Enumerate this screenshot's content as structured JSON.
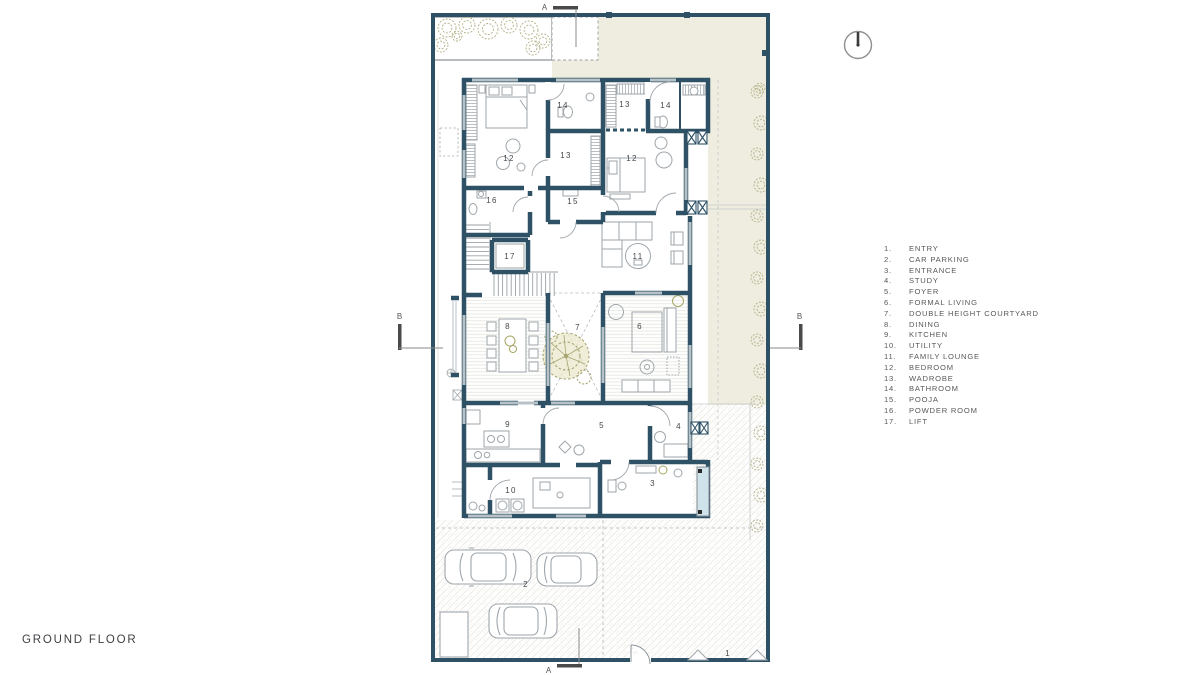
{
  "page": {
    "floor_label": "GROUND FLOOR"
  },
  "compass": {
    "icon": "north-indicator"
  },
  "colors": {
    "wall": "#2e5166",
    "beige": "#eeede0",
    "plant": "#b3b086",
    "glass": "#cfe3ea"
  },
  "section_markers": [
    {
      "label": "A",
      "x": 545,
      "y": 10,
      "pos": "top"
    },
    {
      "label": "A",
      "x": 549,
      "y": 673,
      "pos": "bottom"
    },
    {
      "label": "B",
      "x": 400,
      "y": 319,
      "pos": "left"
    },
    {
      "label": "B",
      "x": 800,
      "y": 319,
      "pos": "right"
    }
  ],
  "legend": {
    "items": [
      {
        "num": "1.",
        "label": "ENTRY"
      },
      {
        "num": "2.",
        "label": "CAR PARKING"
      },
      {
        "num": "3.",
        "label": "ENTRANCE"
      },
      {
        "num": "4.",
        "label": "STUDY"
      },
      {
        "num": "5.",
        "label": "FOYER"
      },
      {
        "num": "6.",
        "label": "FORMAL LIVING"
      },
      {
        "num": "7.",
        "label": "DOUBLE HEIGHT COURTYARD"
      },
      {
        "num": "8.",
        "label": "DINING"
      },
      {
        "num": "9.",
        "label": "KITCHEN"
      },
      {
        "num": "10.",
        "label": "UTILITY"
      },
      {
        "num": "11.",
        "label": "FAMILY LOUNGE"
      },
      {
        "num": "12.",
        "label": "BEDROOM"
      },
      {
        "num": "13.",
        "label": "WADROBE"
      },
      {
        "num": "14.",
        "label": "BATHROOM"
      },
      {
        "num": "15.",
        "label": "POOJA"
      },
      {
        "num": "16.",
        "label": "POWDER ROOM"
      },
      {
        "num": "17.",
        "label": "LIFT"
      }
    ]
  },
  "plan": {
    "room_labels": [
      {
        "num": "14",
        "x": 563,
        "y": 108
      },
      {
        "num": "13",
        "x": 625,
        "y": 107
      },
      {
        "num": "14",
        "x": 666,
        "y": 108
      },
      {
        "num": "12",
        "x": 509,
        "y": 161
      },
      {
        "num": "13",
        "x": 566,
        "y": 158
      },
      {
        "num": "12",
        "x": 632,
        "y": 161
      },
      {
        "num": "16",
        "x": 492,
        "y": 203
      },
      {
        "num": "15",
        "x": 573,
        "y": 204
      },
      {
        "num": "17",
        "x": 510,
        "y": 259
      },
      {
        "num": "11",
        "x": 638,
        "y": 259
      },
      {
        "num": "8",
        "x": 508,
        "y": 329
      },
      {
        "num": "7",
        "x": 578,
        "y": 330
      },
      {
        "num": "6",
        "x": 640,
        "y": 329
      },
      {
        "num": "9",
        "x": 508,
        "y": 427
      },
      {
        "num": "5",
        "x": 602,
        "y": 428
      },
      {
        "num": "4",
        "x": 679,
        "y": 429
      },
      {
        "num": "10",
        "x": 511,
        "y": 493
      },
      {
        "num": "3",
        "x": 653,
        "y": 486
      },
      {
        "num": "2",
        "x": 526,
        "y": 587
      },
      {
        "num": "1",
        "x": 728,
        "y": 656
      }
    ]
  }
}
